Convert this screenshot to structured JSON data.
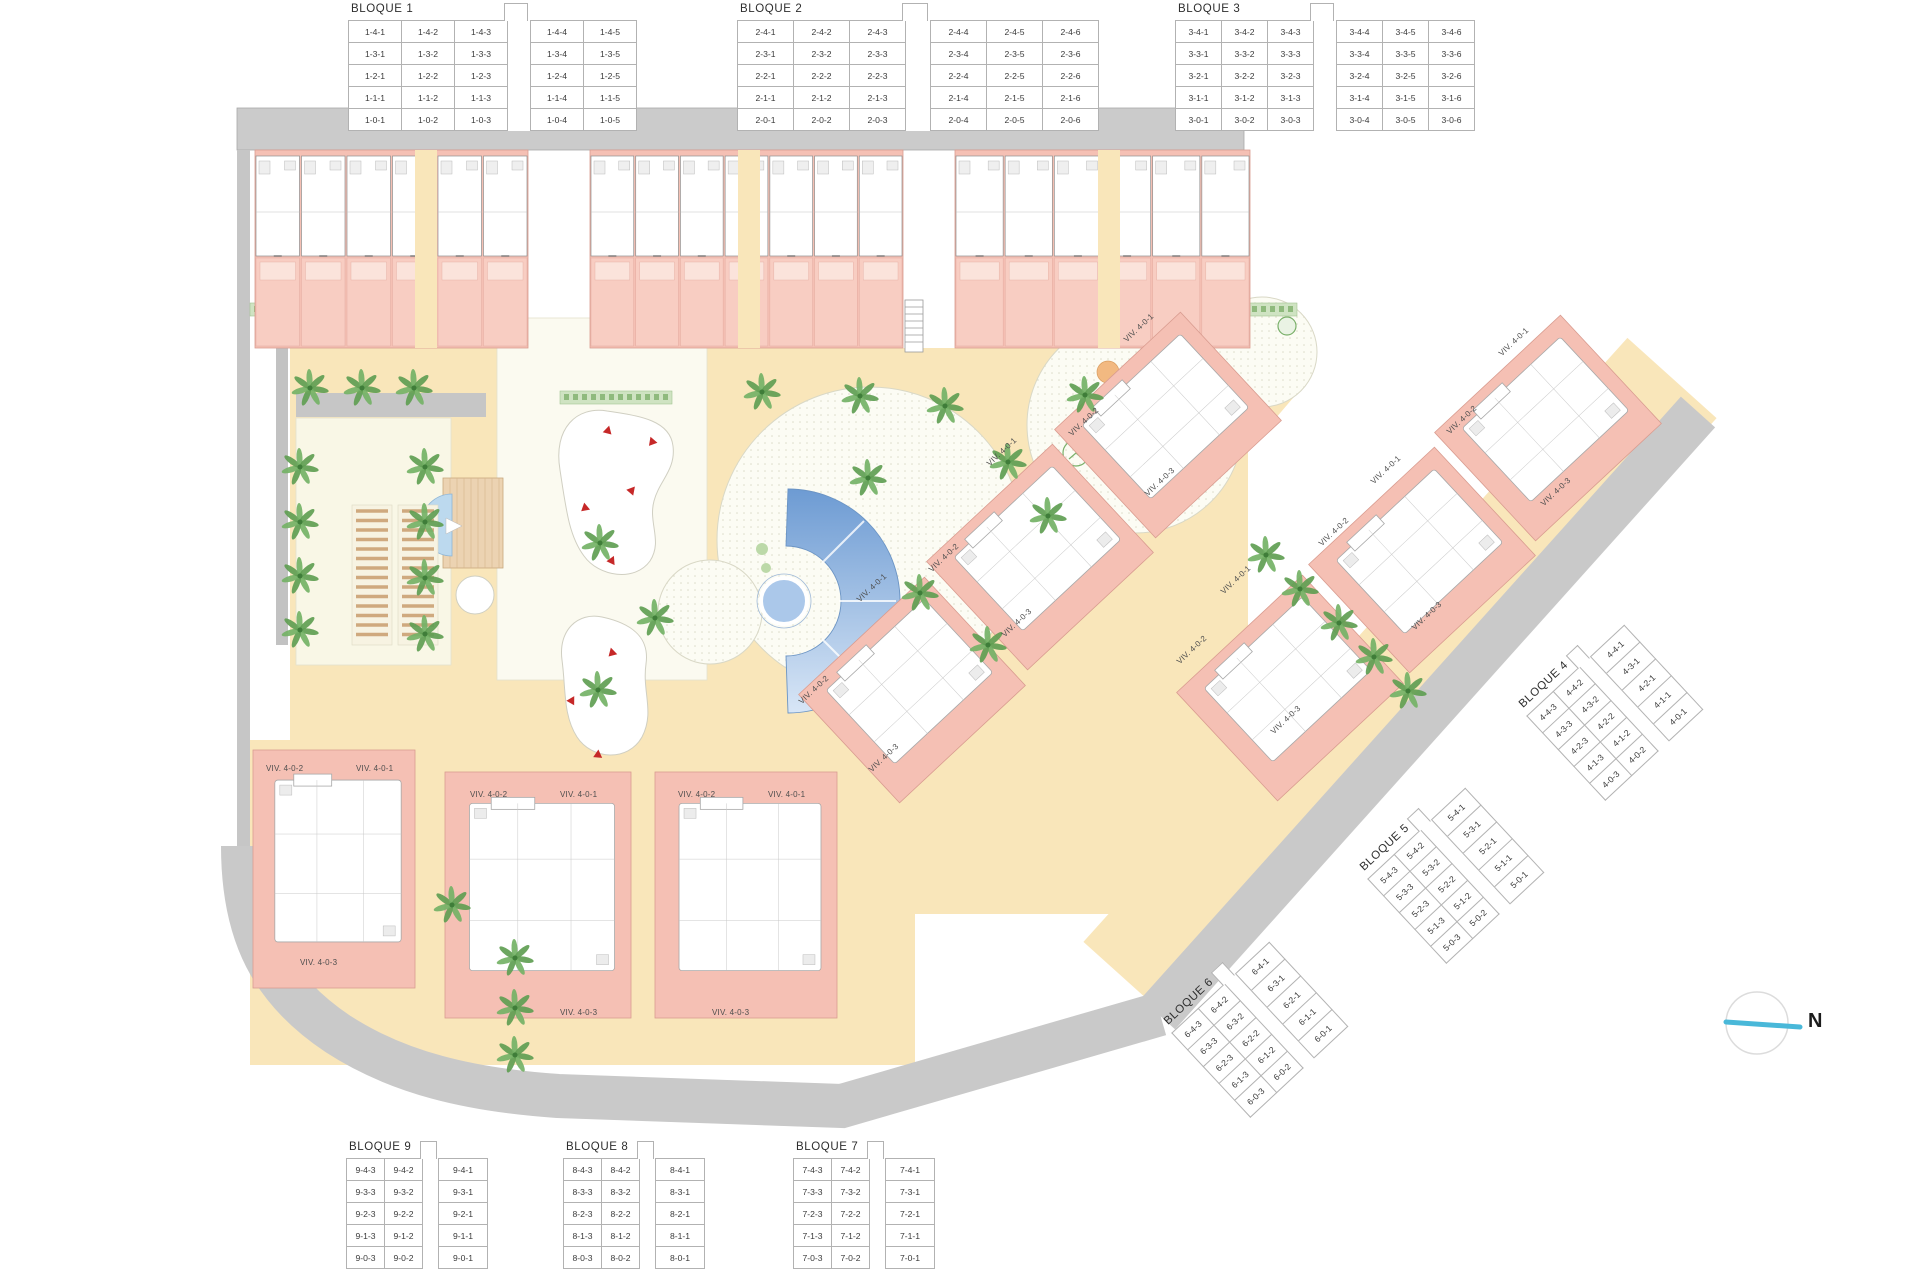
{
  "tables": {
    "bloque1": {
      "title": "BLOQUE 1",
      "rows": [
        [
          "1-4-1",
          "1-4-2",
          "1-4-3",
          "",
          "1-4-4",
          "1-4-5"
        ],
        [
          "1-3-1",
          "1-3-2",
          "1-3-3",
          "",
          "1-3-4",
          "1-3-5"
        ],
        [
          "1-2-1",
          "1-2-2",
          "1-2-3",
          "",
          "1-2-4",
          "1-2-5"
        ],
        [
          "1-1-1",
          "1-1-2",
          "1-1-3",
          "",
          "1-1-4",
          "1-1-5"
        ],
        [
          "1-0-1",
          "1-0-2",
          "1-0-3",
          "",
          "1-0-4",
          "1-0-5"
        ]
      ]
    },
    "bloque2": {
      "title": "BLOQUE 2",
      "rows": [
        [
          "2-4-1",
          "2-4-2",
          "2-4-3",
          "",
          "2-4-4",
          "2-4-5",
          "2-4-6"
        ],
        [
          "2-3-1",
          "2-3-2",
          "2-3-3",
          "",
          "2-3-4",
          "2-3-5",
          "2-3-6"
        ],
        [
          "2-2-1",
          "2-2-2",
          "2-2-3",
          "",
          "2-2-4",
          "2-2-5",
          "2-2-6"
        ],
        [
          "2-1-1",
          "2-1-2",
          "2-1-3",
          "",
          "2-1-4",
          "2-1-5",
          "2-1-6"
        ],
        [
          "2-0-1",
          "2-0-2",
          "2-0-3",
          "",
          "2-0-4",
          "2-0-5",
          "2-0-6"
        ]
      ]
    },
    "bloque3": {
      "title": "BLOQUE 3",
      "rows": [
        [
          "3-4-1",
          "3-4-2",
          "3-4-3",
          "",
          "3-4-4",
          "3-4-5",
          "3-4-6"
        ],
        [
          "3-3-1",
          "3-3-2",
          "3-3-3",
          "",
          "3-3-4",
          "3-3-5",
          "3-3-6"
        ],
        [
          "3-2-1",
          "3-2-2",
          "3-2-3",
          "",
          "3-2-4",
          "3-2-5",
          "3-2-6"
        ],
        [
          "3-1-1",
          "3-1-2",
          "3-1-3",
          "",
          "3-1-4",
          "3-1-5",
          "3-1-6"
        ],
        [
          "3-0-1",
          "3-0-2",
          "3-0-3",
          "",
          "3-0-4",
          "3-0-5",
          "3-0-6"
        ]
      ]
    },
    "bloque4": {
      "title": "BLOQUE 4",
      "rows": [
        [
          "4-4-3",
          "4-4-2",
          "",
          "4-4-1"
        ],
        [
          "4-3-3",
          "4-3-2",
          "",
          "4-3-1"
        ],
        [
          "4-2-3",
          "4-2-2",
          "",
          "4-2-1"
        ],
        [
          "4-1-3",
          "4-1-2",
          "",
          "4-1-1"
        ],
        [
          "4-0-3",
          "4-0-2",
          "",
          "4-0-1"
        ]
      ]
    },
    "bloque5": {
      "title": "BLOQUE 5",
      "rows": [
        [
          "5-4-3",
          "5-4-2",
          "",
          "5-4-1"
        ],
        [
          "5-3-3",
          "5-3-2",
          "",
          "5-3-1"
        ],
        [
          "5-2-3",
          "5-2-2",
          "",
          "5-2-1"
        ],
        [
          "5-1-3",
          "5-1-2",
          "",
          "5-1-1"
        ],
        [
          "5-0-3",
          "5-0-2",
          "",
          "5-0-1"
        ]
      ]
    },
    "bloque6": {
      "title": "BLOQUE 6",
      "rows": [
        [
          "6-4-3",
          "6-4-2",
          "",
          "6-4-1"
        ],
        [
          "6-3-3",
          "6-3-2",
          "",
          "6-3-1"
        ],
        [
          "6-2-3",
          "6-2-2",
          "",
          "6-2-1"
        ],
        [
          "6-1-3",
          "6-1-2",
          "",
          "6-1-1"
        ],
        [
          "6-0-3",
          "6-0-2",
          "",
          "6-0-1"
        ]
      ]
    },
    "bloque7": {
      "title": "BLOQUE 7",
      "rows": [
        [
          "7-4-3",
          "7-4-2",
          "",
          "7-4-1"
        ],
        [
          "7-3-3",
          "7-3-2",
          "",
          "7-3-1"
        ],
        [
          "7-2-3",
          "7-2-2",
          "",
          "7-2-1"
        ],
        [
          "7-1-3",
          "7-1-2",
          "",
          "7-1-1"
        ],
        [
          "7-0-3",
          "7-0-2",
          "",
          "7-0-1"
        ]
      ]
    },
    "bloque8": {
      "title": "BLOQUE 8",
      "rows": [
        [
          "8-4-3",
          "8-4-2",
          "",
          "8-4-1"
        ],
        [
          "8-3-3",
          "8-3-2",
          "",
          "8-3-1"
        ],
        [
          "8-2-3",
          "8-2-2",
          "",
          "8-2-1"
        ],
        [
          "8-1-3",
          "8-1-2",
          "",
          "8-1-1"
        ],
        [
          "8-0-3",
          "8-0-2",
          "",
          "8-0-1"
        ]
      ]
    },
    "bloque9": {
      "title": "BLOQUE 9",
      "rows": [
        [
          "9-4-3",
          "9-4-2",
          "",
          "9-4-1"
        ],
        [
          "9-3-3",
          "9-3-2",
          "",
          "9-3-1"
        ],
        [
          "9-2-3",
          "9-2-2",
          "",
          "9-2-1"
        ],
        [
          "9-1-3",
          "9-1-2",
          "",
          "9-1-1"
        ],
        [
          "9-0-3",
          "9-0-2",
          "",
          "9-0-1"
        ]
      ]
    }
  },
  "viv_labels": [
    "VIV. 4-0-2",
    "VIV. 4-0-1",
    "VIV. 4-0-3",
    "VIV. 4-0-2",
    "VIV. 4-0-1",
    "VIV. 4-0-3",
    "VIV. 4-0-2",
    "VIV. 4-0-1",
    "VIV. 4-0-3",
    "VIV. 4-0-1",
    "VIV. 4-0-2",
    "VIV. 4-0-3",
    "VIV. 4-0-1",
    "VIV. 4-0-2",
    "VIV. 4-0-3",
    "VIV. 4-0-1",
    "VIV. 4-0-2",
    "VIV. 4-0-3",
    "VIV. 4-0-1",
    "VIV. 4-0-2",
    "VIV. 4-0-3",
    "VIV. 4-0-1",
    "VIV. 4-0-2",
    "VIV. 4-0-3",
    "VIV. 4-0-1",
    "VIV. 4-0-2",
    "VIV. 4-0-3"
  ],
  "compass": {
    "north_label": "N"
  },
  "colors": {
    "building_pink": "#f5c0b4",
    "garden_pink": "#f8cdc2",
    "path_yellow": "#f9e6ba",
    "road_gray": "#c9c9c9",
    "plaza_cream": "#fcfcf4",
    "lawn_cream": "#f9f7e6",
    "pool_blue_dark": "#79a5d8",
    "pool_blue_light": "#d8e6f6",
    "palm_green": "#69a55c",
    "hedge_green": "#cfe3c2",
    "marker_red": "#c62828",
    "north_cyan": "#49b8d9"
  }
}
